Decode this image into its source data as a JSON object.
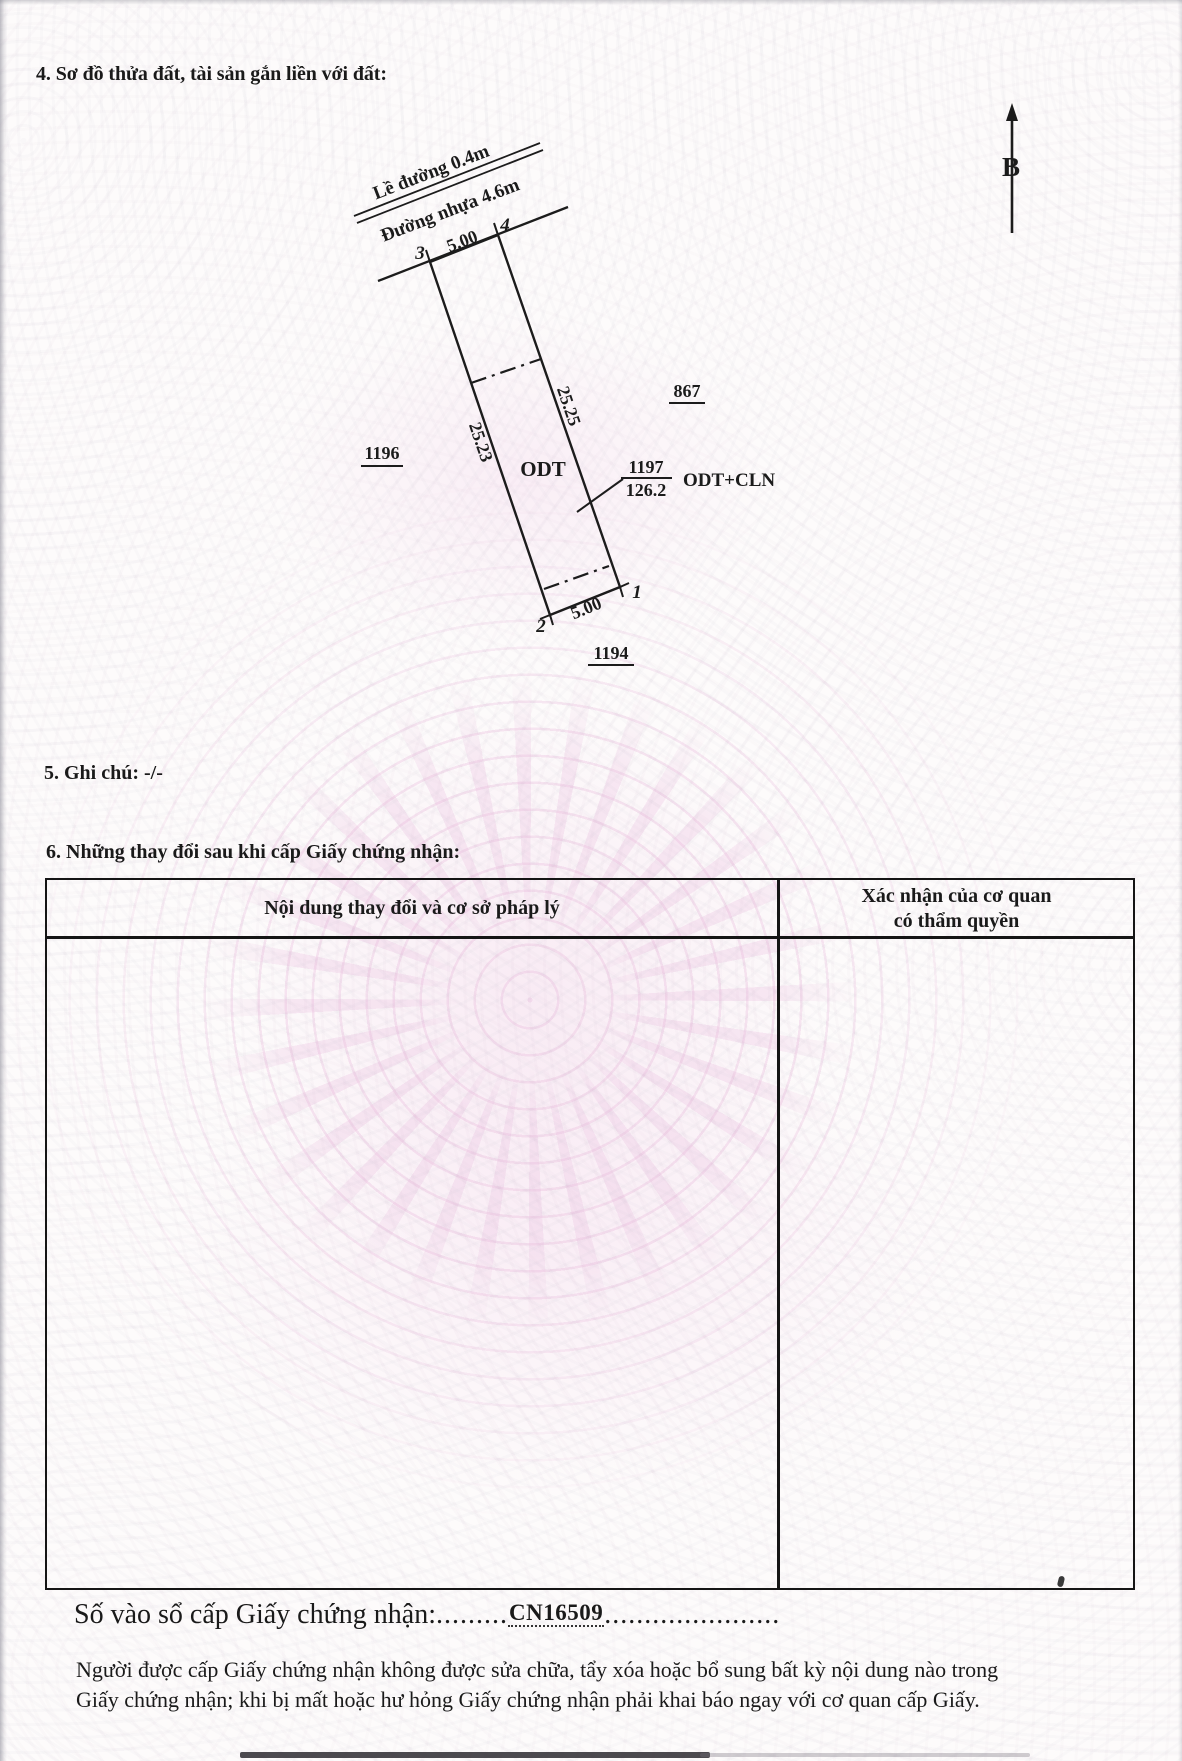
{
  "page": {
    "section4_title": "4. Sơ đồ thửa đất, tài sản gắn liền với đất:",
    "section5_title": "5. Ghi chú: -/-",
    "section6_title": "6. Những thay đổi sau khi cấp Giấy chứng nhận:",
    "footer_line1": "Người được cấp Giấy chứng nhận không được sửa chữa, tẩy xóa hoặc bổ sung bất kỳ nội dung nào trong",
    "footer_line2": "Giấy chứng nhận; khi bị mất hoặc hư hỏng Giấy chứng nhận phải khai báo ngay với cơ quan cấp Giấy."
  },
  "diagram": {
    "north_label": "B",
    "road_edge_label": "Lề đường 0.4m",
    "road_label": "Đường nhựa 4.6m",
    "top_width": "5.00",
    "bottom_width": "5.00",
    "left_length": "25.23",
    "right_length": "25.25",
    "land_use_label": "ODT",
    "parcel_number": "1197",
    "parcel_area": "126.2",
    "parcel_use": "ODT+CLN",
    "adjacent_left": "1196",
    "adjacent_right": "867",
    "adjacent_bottom": "1194",
    "corners": {
      "c1": "1",
      "c2": "2",
      "c3": "3",
      "c4": "4"
    }
  },
  "table": {
    "col1_header": "Nội dung thay đổi và cơ sở pháp lý",
    "col2_header_line1": "Xác nhận của cơ quan",
    "col2_header_line2": "có thẩm quyền"
  },
  "registry": {
    "label": "Số vào sổ cấp Giấy chứng nhận:",
    "dots_before": ".........",
    "value": "CN16509",
    "dots_after": "......................"
  },
  "colors": {
    "ink": "#1a1a1a",
    "watermark_pink": "#eccade"
  }
}
